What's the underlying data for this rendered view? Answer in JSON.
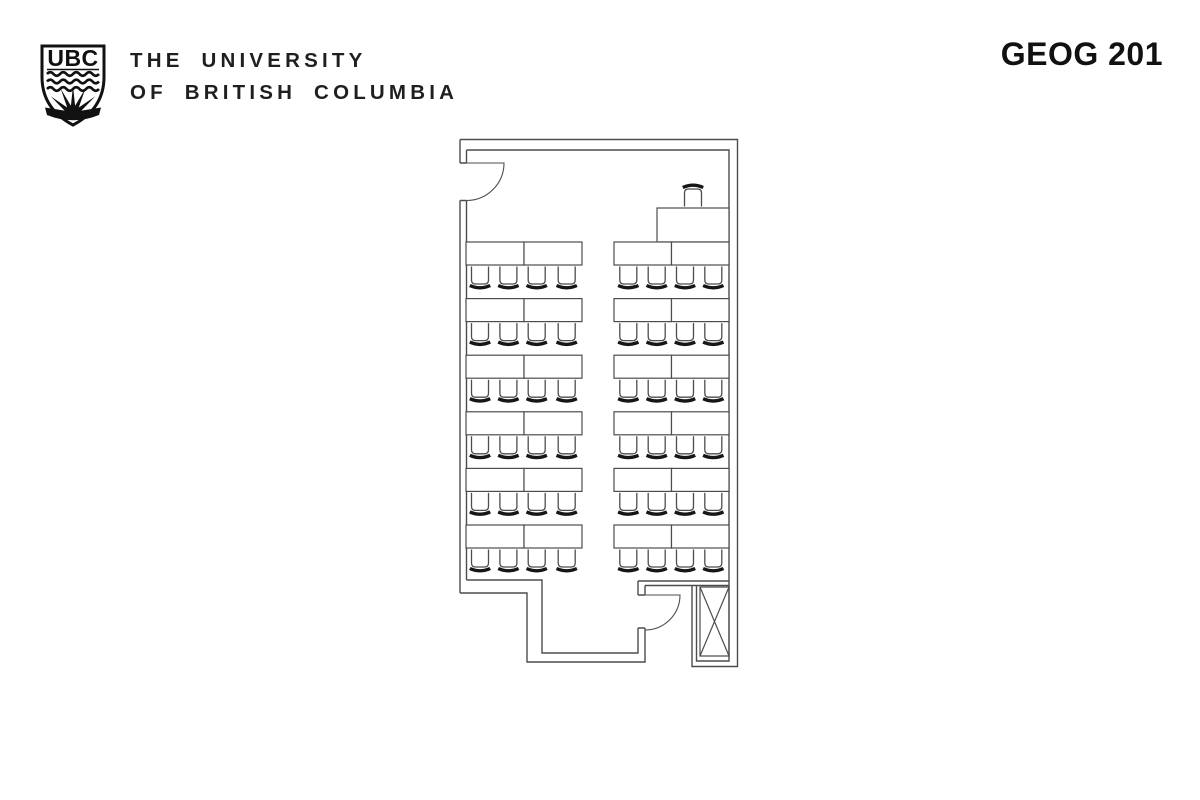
{
  "header": {
    "logo_acronym": "UBC",
    "institution_line1": "THE UNIVERSITY",
    "institution_line2": "OF BRITISH COLUMBIA",
    "course_code": "GEOG 201"
  },
  "floorplan": {
    "kind": "classroom seating plan",
    "desk_rows": 6,
    "desk_columns": 2,
    "tables_per_block": 2,
    "chairs_per_block": 4,
    "student_tables_total": 24,
    "student_chairs_total": 48,
    "instructor_tables": 1,
    "instructor_chairs": 1,
    "doors": 2,
    "shaft_symbol": "crossed-box bottom-right",
    "colors": {
      "background": "#ffffff",
      "plan_line": "#4d4d4d",
      "chair_back": "#161616",
      "text": "#1f1f1f"
    }
  }
}
